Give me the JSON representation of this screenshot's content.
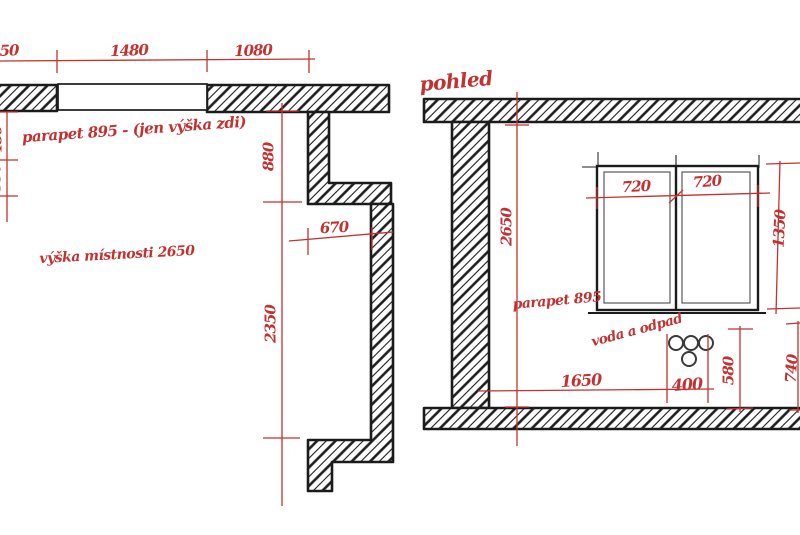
{
  "meta": {
    "kind": "hand-sketched architectural drawing",
    "ink_color": "#1b1b1b",
    "accent_color": "#c23230",
    "background_color": "#ffffff"
  },
  "plan": {
    "dim_top_left_partial": "50",
    "dim_top_window": "1480",
    "dim_top_wall": "1080",
    "dim_left_upper_partial": "480",
    "dim_left_lower_partial": "350",
    "note_parapet": "parapet 895 - (jen výška zdi)",
    "dim_pier_height": "880",
    "dim_niche": "670",
    "note_room_height": "výška místnosti 2650",
    "dim_wall_run": "2350"
  },
  "elevation": {
    "title": "pohled",
    "dim_room_height": "2650",
    "dim_pane_left": "720",
    "dim_pane_right": "720",
    "dim_window_height": "1350",
    "note_parapet": "parapet 895",
    "note_utilities": "voda a odpad",
    "dim_floor_run": "1650",
    "dim_utility_width": "400",
    "dim_utility_height": "580",
    "dim_right_partial": "740"
  }
}
